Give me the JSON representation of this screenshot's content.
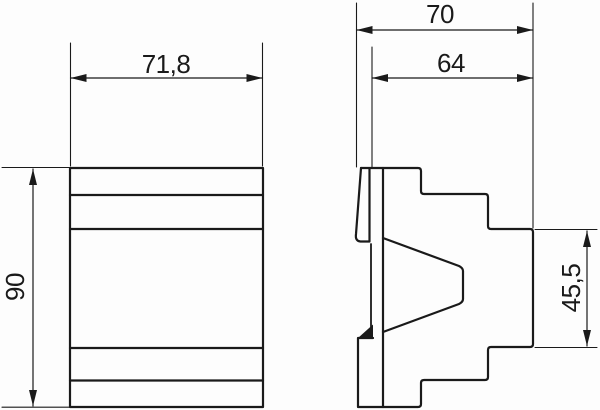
{
  "drawing": {
    "type": "technical-dimension-drawing",
    "colors": {
      "line": "#1a1a1a",
      "background": "#fdfdfd"
    },
    "views": {
      "front": {
        "dimensions": {
          "width": "71,8",
          "height": "90"
        }
      },
      "side": {
        "dimensions": {
          "depth_total": "70",
          "depth_body": "64",
          "rear_height": "45,5"
        }
      }
    }
  }
}
